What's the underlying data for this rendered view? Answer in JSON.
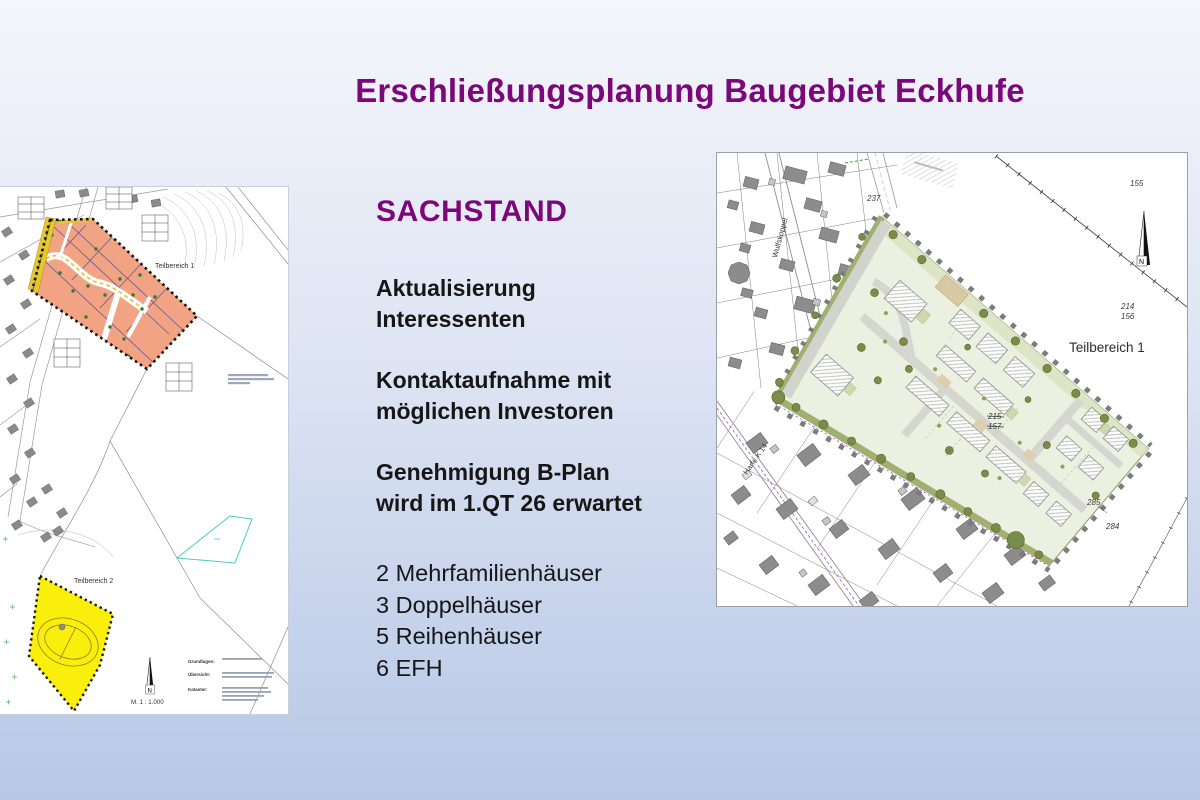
{
  "colors": {
    "bg-top": "#f5f6fc",
    "bg-bottom": "#b7c7e6",
    "title-purple": "#7b077b",
    "text-dark": "#161616",
    "plan-parcel-orange": "#f1a383",
    "plan-area-yellow": "#f9ef0a",
    "site-fill-green": "#ecf0e1",
    "hedge-green": "#6d8544"
  },
  "title": "Erschließungsplanung Baugebiet Eckhufe",
  "sachstand": {
    "heading": "SACHSTAND",
    "bold_paragraphs": [
      [
        "Aktualisierung",
        "Interessenten"
      ],
      [
        "Kontaktaufnahme mit",
        "möglichen Investoren"
      ],
      [
        "Genehmigung B-Plan",
        "wird im 1.QT 26 erwartet"
      ]
    ],
    "list": [
      "2 Mehrfamilienhäuser",
      "3 Doppelhäuser",
      "5 Reihenhäuser",
      "6 EFH"
    ]
  },
  "left_map": {
    "teilbereich1_label": "Teilbereich 1",
    "teilbereich2_label": "Teilbereich 2",
    "scale_text": "M. 1 : 1.000",
    "north_letter": "N",
    "legend_labels": {
      "grundlagen": "Grundlagen:",
      "uebersicht": "Übersicht:",
      "kataster": "Kataster:"
    }
  },
  "right_map": {
    "teilbereich1_label": "Teilbereich 1",
    "street_wulfskoppel": "Wulfskoppel",
    "street_harfe": "Harfe K 14",
    "north_letter": "N",
    "parcel_numbers": {
      "n155": "155",
      "n237": "237",
      "n214": "214",
      "n156": "156",
      "n215": "215",
      "n157": "157",
      "n285": "285",
      "n284": "284"
    }
  }
}
